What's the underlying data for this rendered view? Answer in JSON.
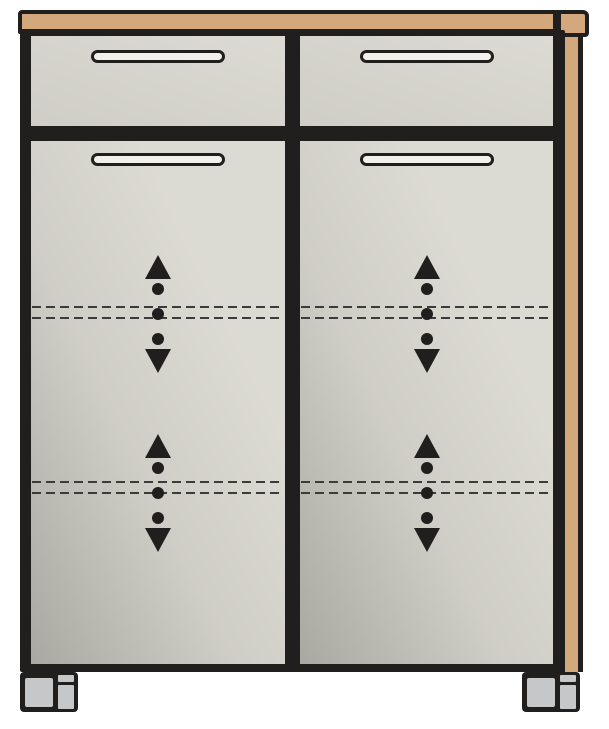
{
  "diagram": {
    "type": "furniture-technical-line-drawing",
    "subject": "cabinet with two top drawers, two doors, adjustable shelf indicators, wood top and side panel, two feet",
    "colors": {
      "background": "#ffffff",
      "outline": "#211e1e",
      "wood": "#d3a87c",
      "panel_light": "#dcdbd3",
      "panel_mid": "#cfcec6",
      "door_light": "#dcdbd3",
      "door_dark": "#a9a8a1",
      "handle_fill": "#f1f0ea",
      "foot_fill": "#c5c7c9",
      "dashed_line": "#3b3b3b"
    },
    "counts": {
      "drawers": 2,
      "doors": 2,
      "handles": 4,
      "shelf_indicators": 4,
      "dashed_shelf_line_pairs": 4,
      "feet": 2
    },
    "icons": {
      "up": "arrow-up-icon",
      "dot": "dot-icon",
      "down": "arrow-down-icon",
      "handle": "handle-bar-icon"
    }
  }
}
